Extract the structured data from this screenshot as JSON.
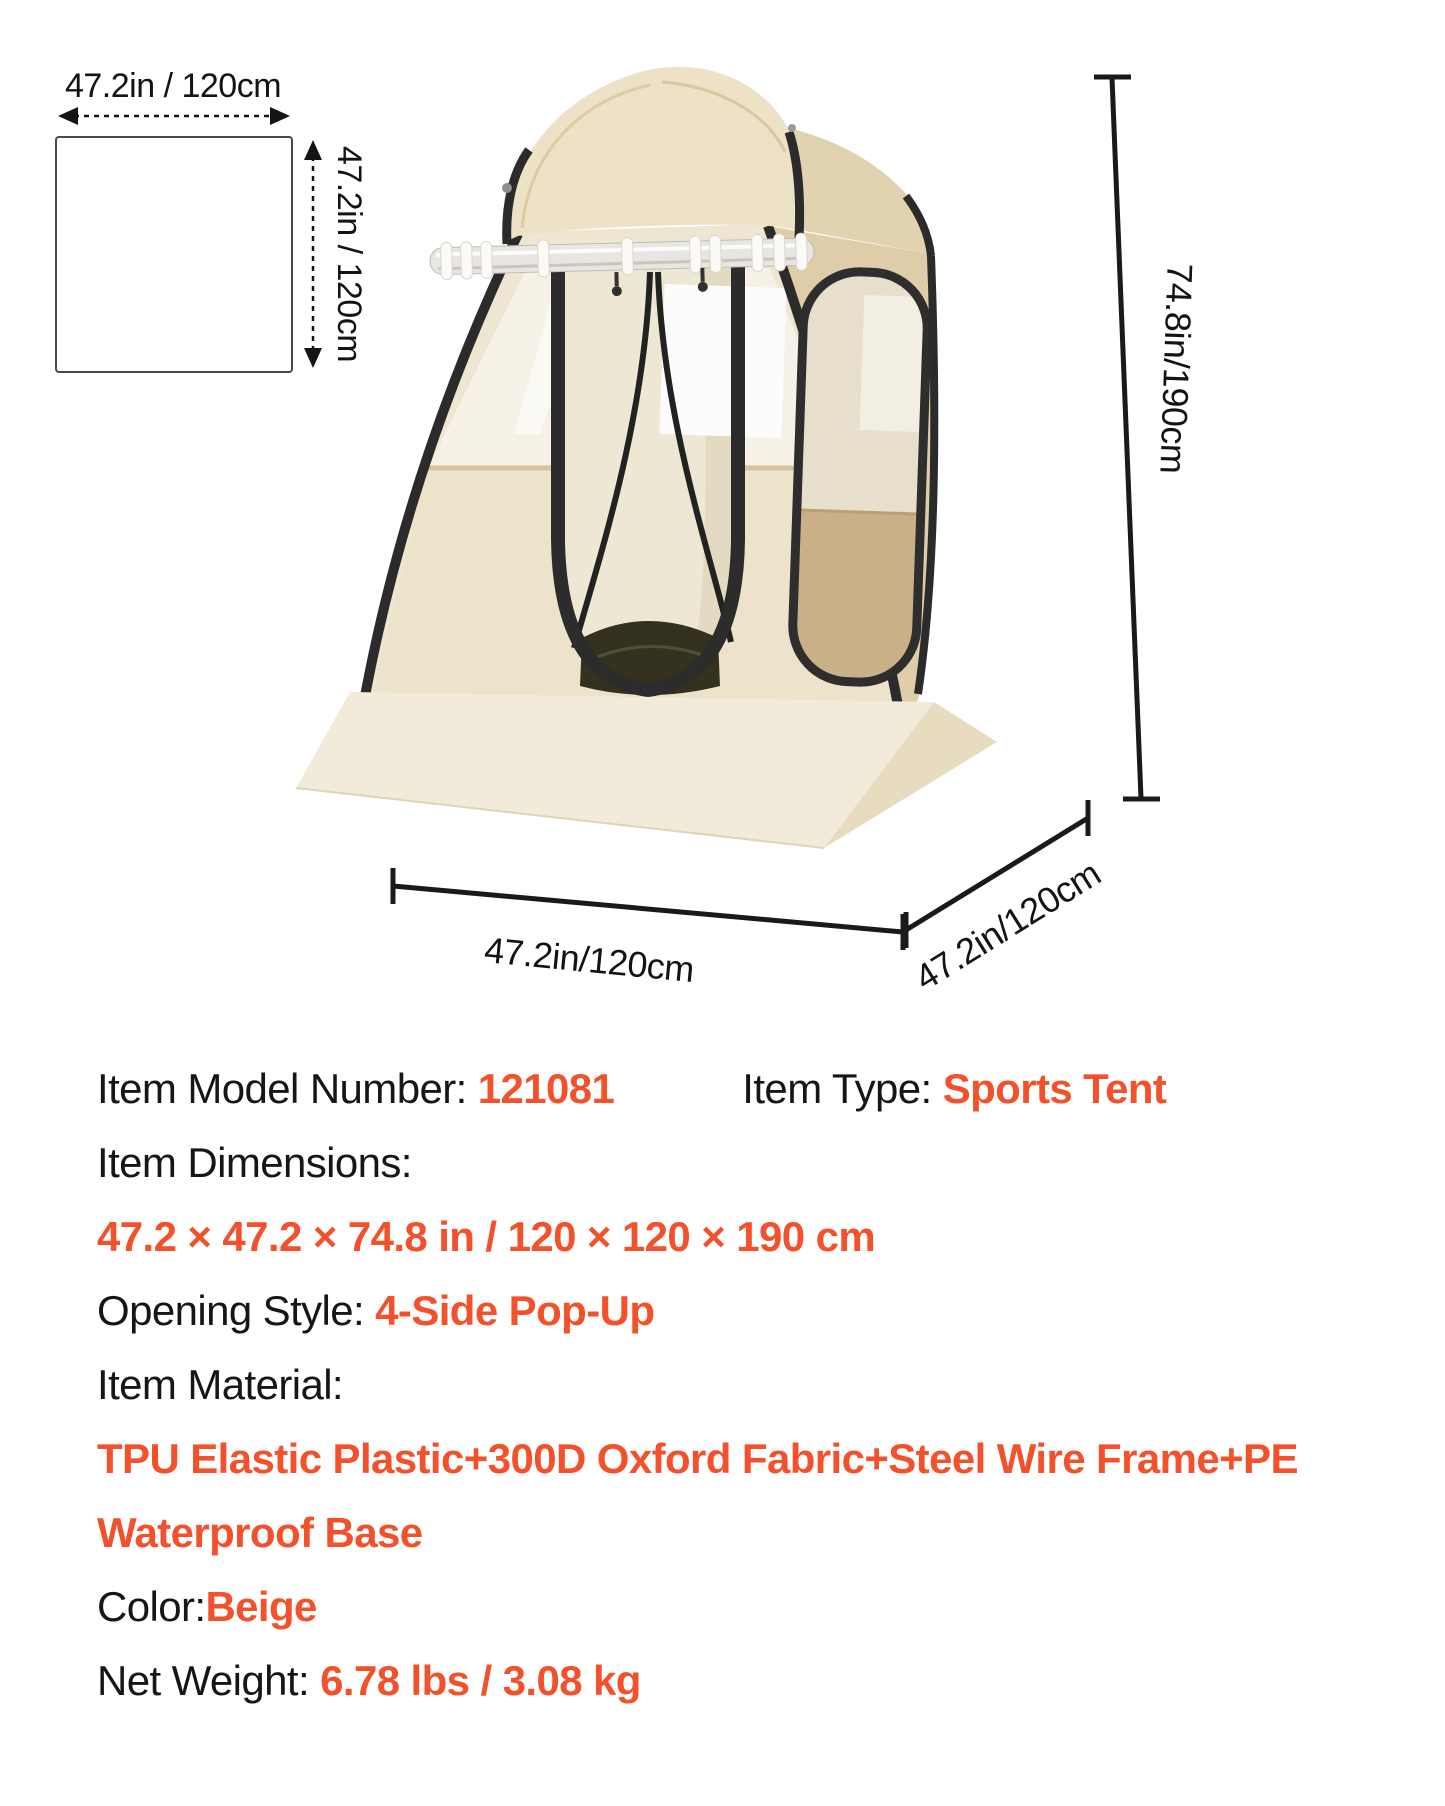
{
  "accent_color": "#F2512B",
  "size_diagram": {
    "width_label": "47.2in / 120cm",
    "height_label": "47.2in / 120cm"
  },
  "tent": {
    "height_label": "74.8in/190cm",
    "width_label": "47.2in/120cm",
    "depth_label": "47.2in/120cm"
  },
  "specs": {
    "model": {
      "label": "Item Model Number: ",
      "value": "121081"
    },
    "type": {
      "label": "Item Type: ",
      "value": "Sports Tent"
    },
    "dimensions": {
      "label": "Item Dimensions:",
      "value": "47.2 × 47.2 × 74.8 in / 120 × 120 × 190 cm"
    },
    "opening": {
      "label": "Opening Style: ",
      "value": "4-Side Pop-Up"
    },
    "material": {
      "label": "Item Material:",
      "value_lines": [
        "TPU Elastic Plastic+300D Oxford Fabric+Steel Wire Frame+PE",
        "Waterproof Base"
      ]
    },
    "color": {
      "label": "Color:",
      "value": "Beige"
    },
    "weight": {
      "label": "Net Weight: ",
      "value": "6.78 lbs / 3.08 kg"
    }
  }
}
